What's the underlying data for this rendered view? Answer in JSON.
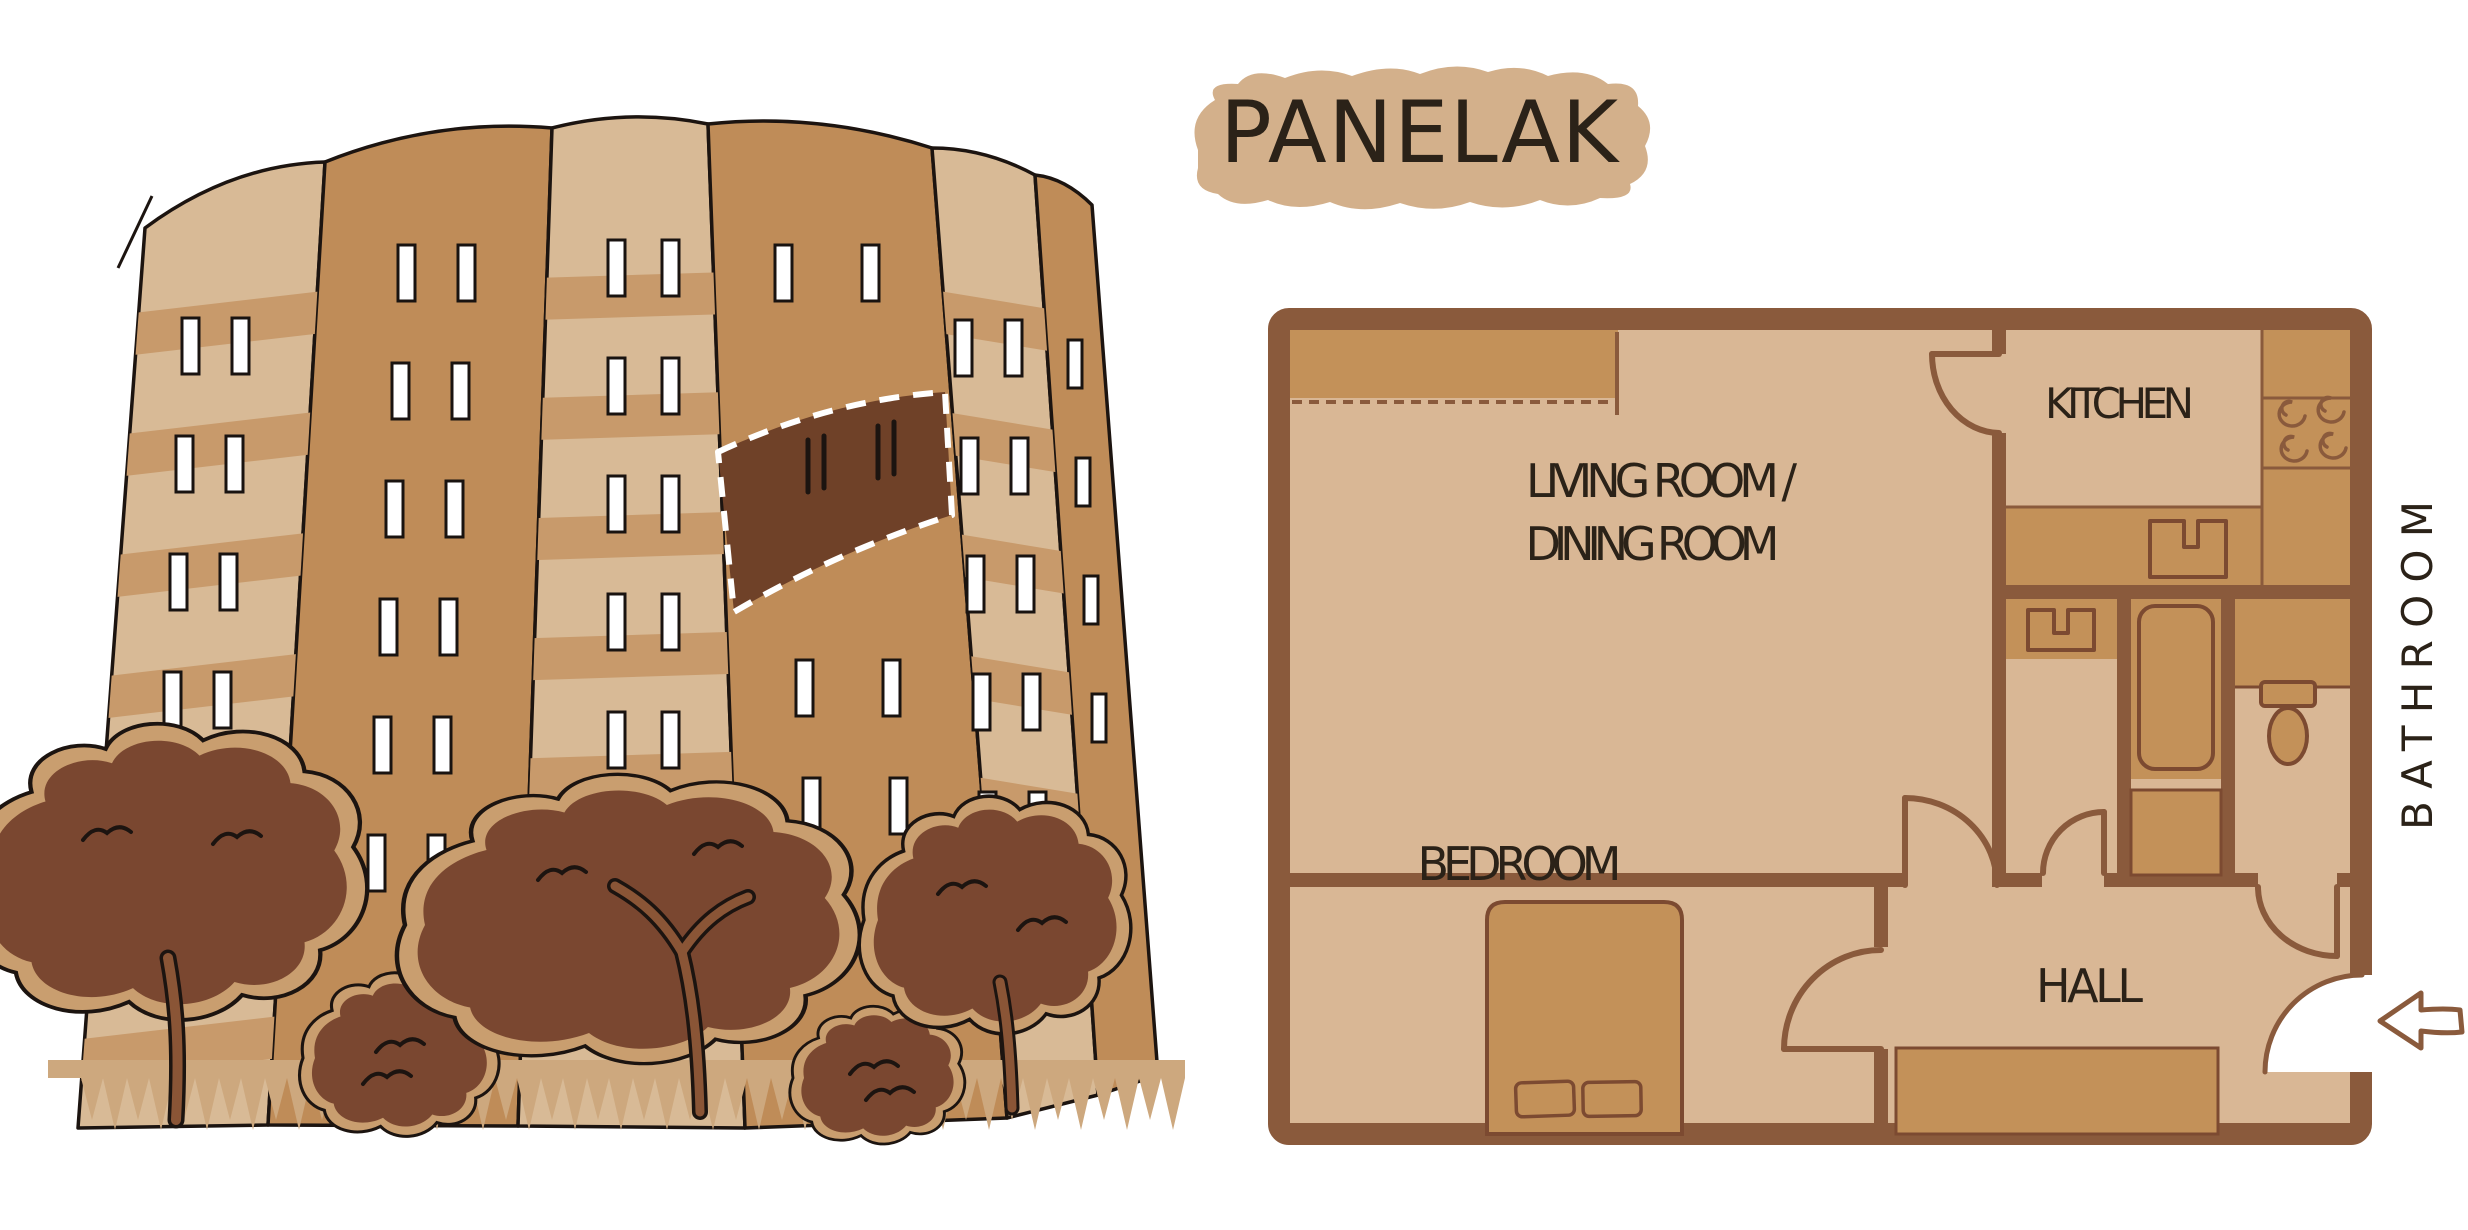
{
  "title": {
    "text": "PANELAK"
  },
  "floor_plan": {
    "labels": {
      "living_line1": "LIVING ROOM /",
      "living_line2": "DINING ROOM",
      "kitchen": "KITCHEN",
      "bedroom": "BEDROOM",
      "hall": "HALL",
      "bathroom": "BATHROOM"
    }
  },
  "colors": {
    "background": "#ffffff",
    "wall": "#8a5a3c",
    "floor": "#d9b795",
    "furniture": "#c39159",
    "fixture_outline": "#7c4a31",
    "highlight_band": "#6f4128",
    "building_light": "#d8ba96",
    "building_mid": "#bf8c58",
    "building_stripe": "#c89a6b",
    "foliage": "#7a4730",
    "foliage_halo": "#c99e6f",
    "grass": "#cda87e",
    "title_background": "#d3b08b",
    "ink": "#1c1410",
    "text": "#2b2218"
  }
}
